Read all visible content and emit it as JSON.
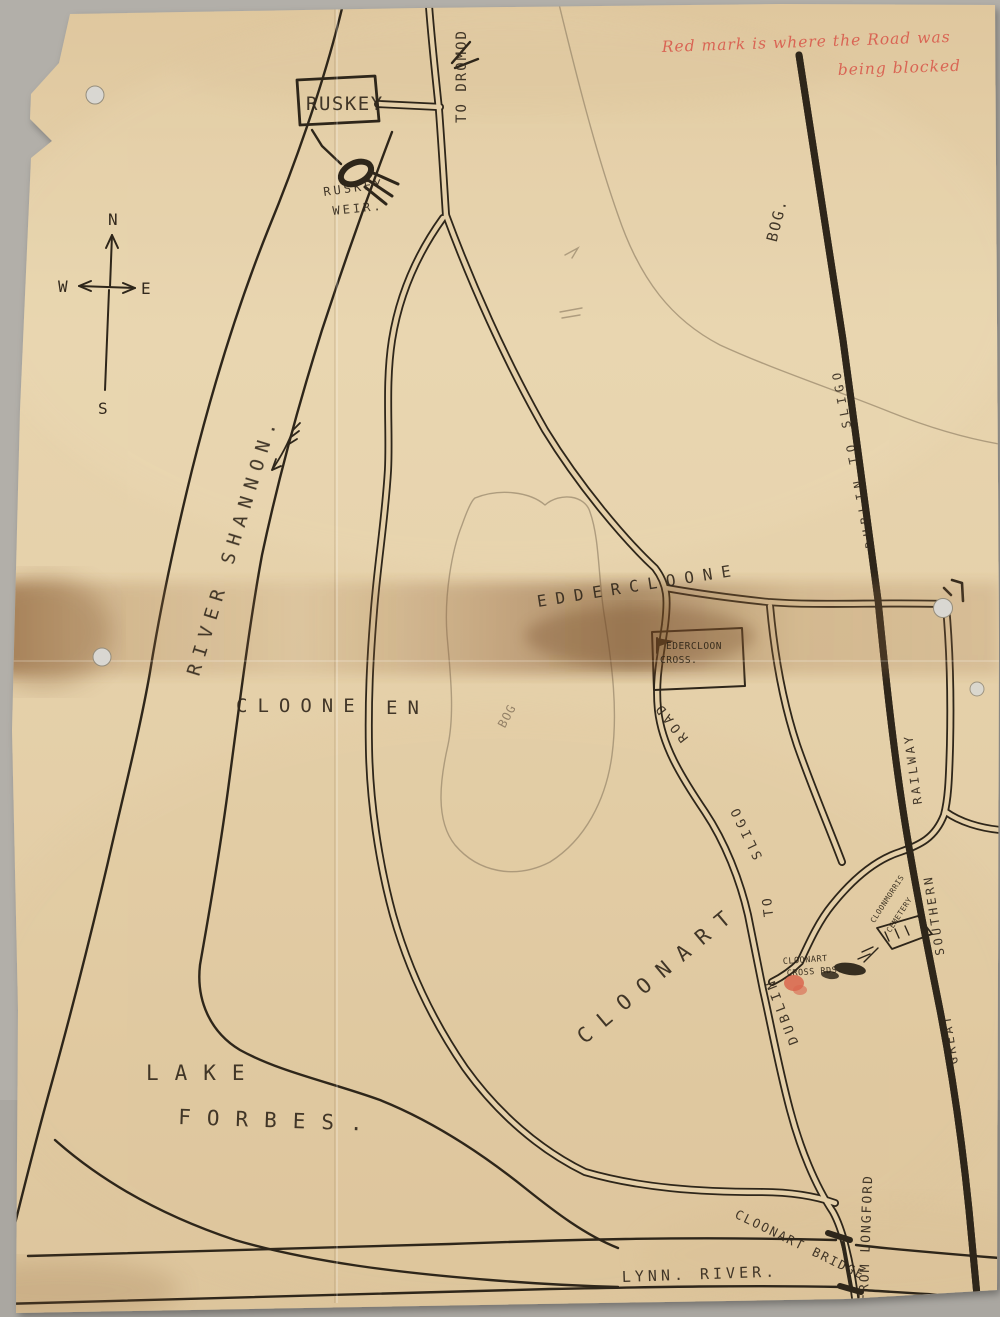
{
  "map_title": "Hand-drawn map of Ruskey / Cloonart district",
  "note": {
    "line1": "Red mark is where the Road was",
    "line2": "being blocked"
  },
  "compass": {
    "north": "N",
    "south": "S",
    "east": "E",
    "west": "W"
  },
  "places": {
    "ruskey": "RUSKEY",
    "to_dromod": "TO DROMOD",
    "ruskey_weir_1": "RUSKEY",
    "ruskey_weir_2": "WEIR.",
    "river_shannon": "RIVER SHANNON.",
    "bog_north": "BOG.",
    "railway_route": "DUBLIN TO SLIGO",
    "eddercloone": "EDDERCLOONE",
    "edercloon_cross_1": "EDERCLOON",
    "edercloon_cross_2": "CROSS.",
    "clooneen_1": "CLOONE",
    "clooneen_2": "EN",
    "bog_center": "BOG",
    "road_word": "ROAD",
    "road_sligo": "SLIGO",
    "road_to": "TO",
    "road_dublin": "DUBLIN",
    "railway_name_1": "RAILWAY",
    "railway_name_2": "SOUTHERN",
    "railway_name_3": "GREAT",
    "cemetery_1": "CLOONMORRIS",
    "cemetery_2": "CEMETERY",
    "cloonart_cross_1": "CLOONART",
    "cloonart_cross_2": "CROSS RDS.",
    "cloonart": "CLOONART",
    "lake_1": "LAKE",
    "lake_2": "FORBES.",
    "lynn_river": "LYNN. RIVER.",
    "cloonart_bridge": "CLOONART BRIDGE",
    "from_longford": "FROM LONGFORD"
  },
  "colors": {
    "backdrop": "#b2afa9",
    "paper": "#e5d0a9",
    "ink": "#2e261a",
    "pencil": "#9b8a6e",
    "red_note": "#d95a4c",
    "red_mark": "#d9664e",
    "stain": "#7a4e28"
  }
}
